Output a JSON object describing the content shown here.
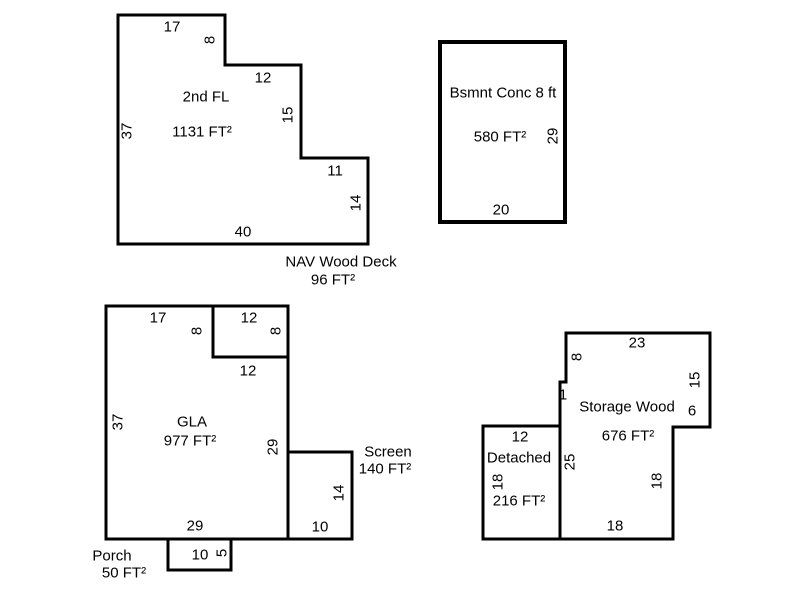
{
  "floorplan": {
    "second_floor": {
      "label": "2nd FL",
      "area": "1131 FT²",
      "dim_top": "17",
      "dim_notch": "8",
      "dim_step": "12",
      "dim_step_side": "15",
      "dim_lower": "11",
      "dim_right": "14",
      "dim_bottom": "40",
      "dim_left": "37"
    },
    "wood_deck": {
      "label": "NAV Wood Deck",
      "area": "96 FT²",
      "dim_top": "12",
      "dim_right": "8"
    },
    "basement": {
      "label": "Bsmnt Conc 8 ft",
      "area": "580 FT²",
      "dim_right": "29",
      "dim_bottom": "20"
    },
    "gla": {
      "label": "GLA",
      "area": "977 FT²",
      "dim_top": "17",
      "dim_notch": "8",
      "dim_inner": "12",
      "dim_left": "37",
      "dim_right": "29",
      "dim_bottom": "29"
    },
    "screen": {
      "label": "Screen",
      "area": "140 FT²",
      "dim_right": "14",
      "dim_bottom": "10"
    },
    "porch": {
      "label": "Porch",
      "area": "50 FT²",
      "dim_bottom": "10",
      "dim_right": "5"
    },
    "storage": {
      "label": "Storage Wood",
      "area": "676 FT²",
      "dim_top": "23",
      "dim_upper_left": "8",
      "dim_upper_right": "15",
      "dim_notch": "6",
      "dim_jog": "1",
      "dim_left": "25",
      "dim_lower_right": "18",
      "dim_bottom": "18"
    },
    "detached": {
      "label": "Detached",
      "area": "216 FT²",
      "dim_top": "12",
      "dim_left": "18"
    },
    "colors": {
      "line": "#000000",
      "background": "#ffffff",
      "text": "#000000"
    }
  }
}
